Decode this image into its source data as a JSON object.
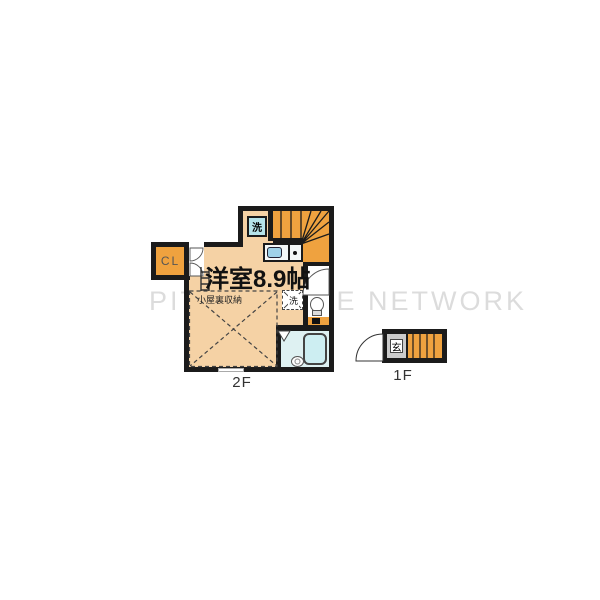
{
  "watermark": {
    "text": "PITAT HOUSE NETWORK"
  },
  "colors": {
    "wall": "#1b1b1b",
    "floor": "#f5d2a5",
    "stairs": "#efa23f",
    "closet": "#efa23f",
    "cyanbox": "#b5e3ea",
    "sink": "#9fd2e8",
    "bathfloor": "#def1f2",
    "bathtub": "#cdeef2",
    "genkan": "#cbcbcb",
    "watermark": "#dcdcdc"
  },
  "floor2": {
    "floor_label": "2F",
    "room_label": "洋室8.9帖",
    "attic_label": "小屋裏収納",
    "closet_label": "CL",
    "washer_label": "洗",
    "washstand_label": "洗"
  },
  "floor1": {
    "floor_label": "1F",
    "entrance_label": "玄"
  }
}
